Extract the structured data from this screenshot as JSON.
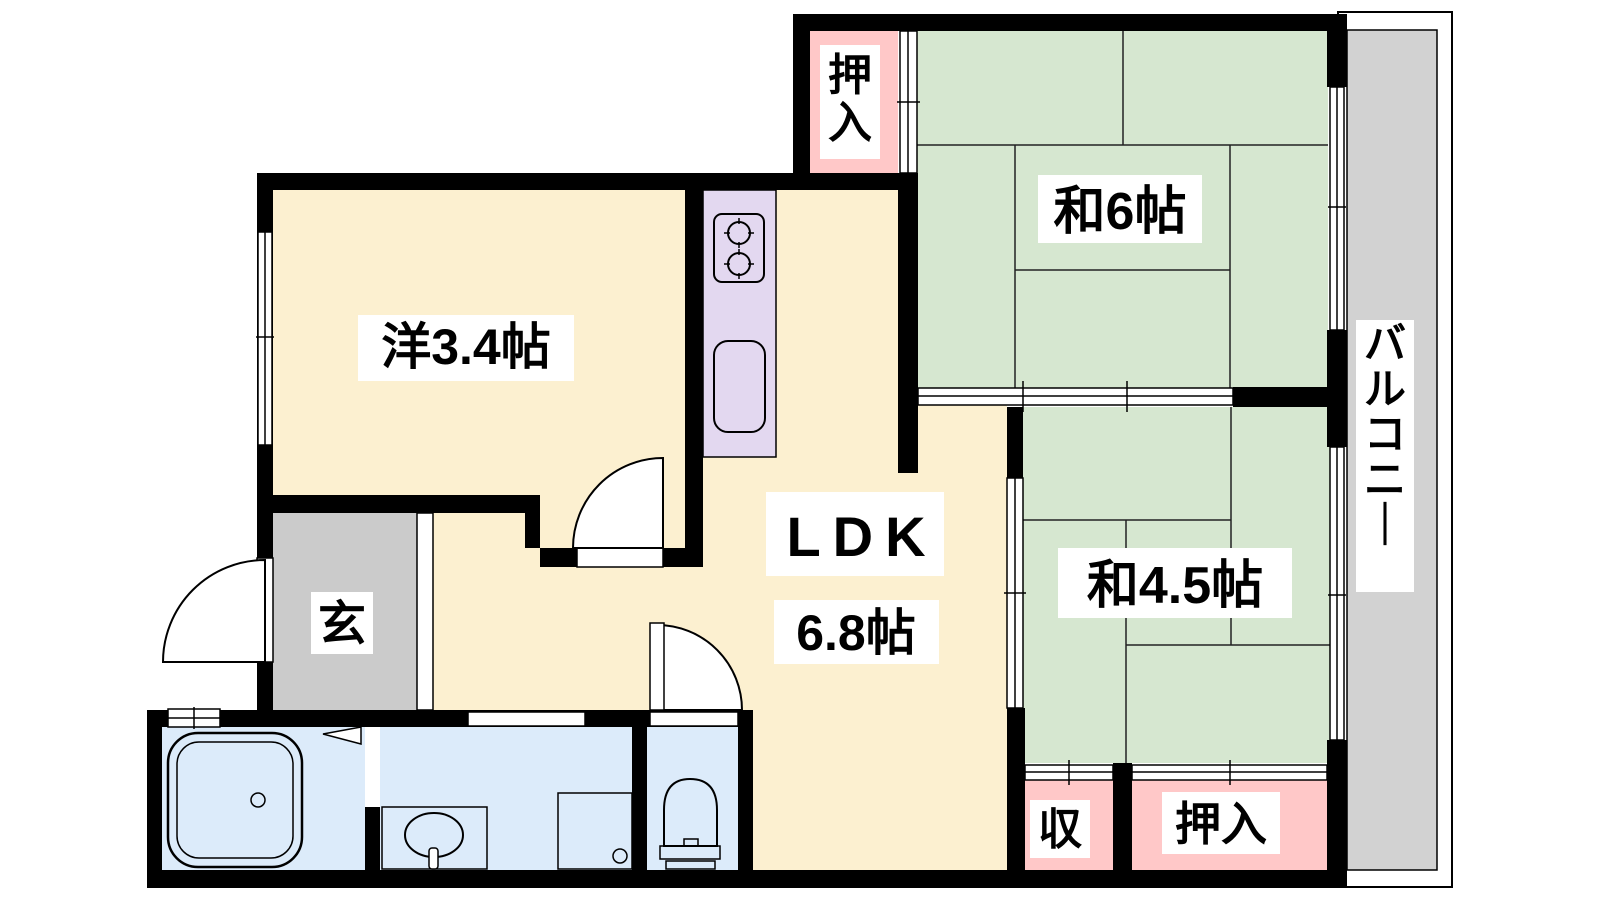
{
  "colors": {
    "wall": "#000000",
    "room_cream": "#fcf0d0",
    "tatami_green": "#d6e7d0",
    "closet_pink": "#ffc8c8",
    "bath_blue": "#dcebfa",
    "kitchen_lavender": "#e3d8f0",
    "entrance_gray": "#cbcbcb",
    "balcony_gray": "#d2d2d2",
    "label_bg": "#ffffff",
    "label_text": "#000000"
  },
  "rooms": {
    "western": {
      "label": "洋3.4帖"
    },
    "ldk": {
      "name": "LDK",
      "size": "6.8帖"
    },
    "japanese6": {
      "label": "和6帖"
    },
    "japanese45": {
      "label": "和4.5帖"
    },
    "closet_top": {
      "label": "押入"
    },
    "closet_bottom": {
      "label": "押入"
    },
    "storage": {
      "label": "収"
    },
    "entrance": {
      "label": "玄"
    },
    "balcony": {
      "label": "バルコニー"
    }
  }
}
